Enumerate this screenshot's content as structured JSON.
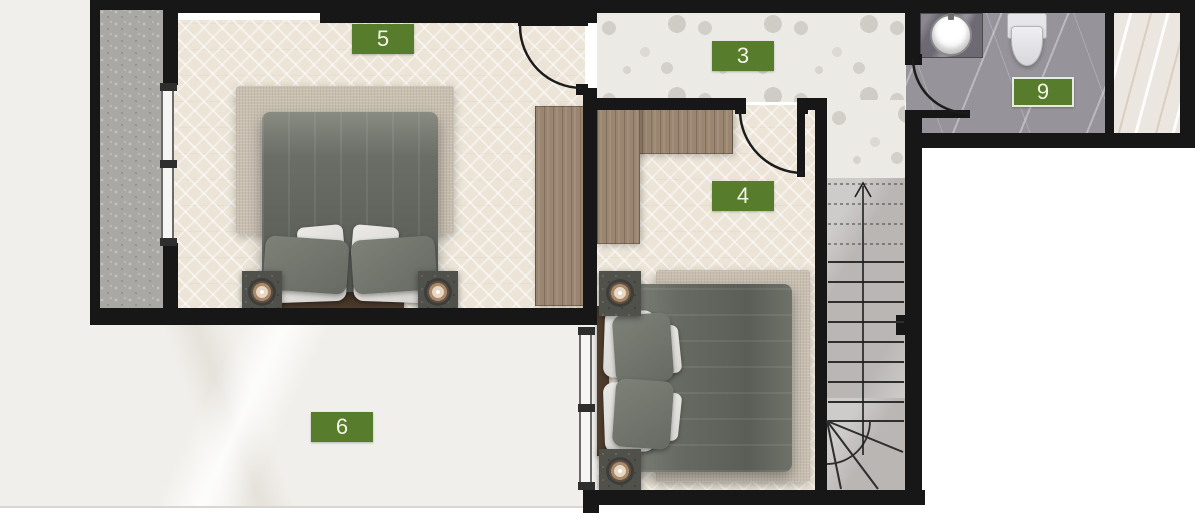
{
  "room_labels": {
    "r5": "5",
    "r3": "3",
    "r4": "4",
    "r9": "9",
    "r6": "6"
  },
  "colors": {
    "label_background": "#567c2c",
    "label_text": "#f4f4e6",
    "wall": "#171717"
  }
}
